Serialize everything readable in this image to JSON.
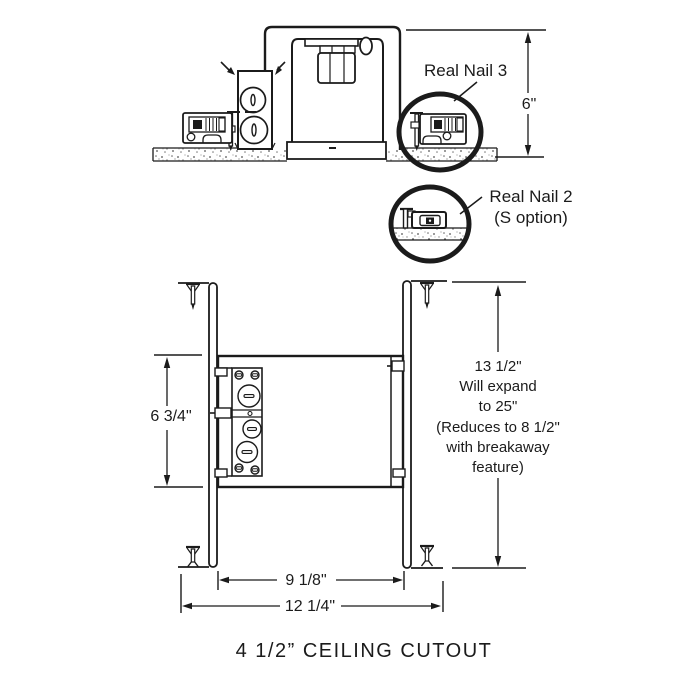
{
  "colors": {
    "ink": "#1b1b1b",
    "background": "#ffffff"
  },
  "upper_view": {
    "real_nail_3_label": "Real Nail 3",
    "real_nail_2_label_line1": "Real Nail 2",
    "real_nail_2_label_line2": "(S option)",
    "height_dim": "6\""
  },
  "lower_view": {
    "depth_dim": "6 3/4\"",
    "bar_span_dim": "9 1/8\"",
    "overall_width_dim": "12 1/4\"",
    "expansion_note_lines": [
      "13 1/2\"",
      "Will expand",
      "to 25\"",
      "(Reduces to 8 1/2\"",
      "with breakaway",
      "feature)"
    ]
  },
  "caption": "4 1/2” CEILING CUTOUT"
}
